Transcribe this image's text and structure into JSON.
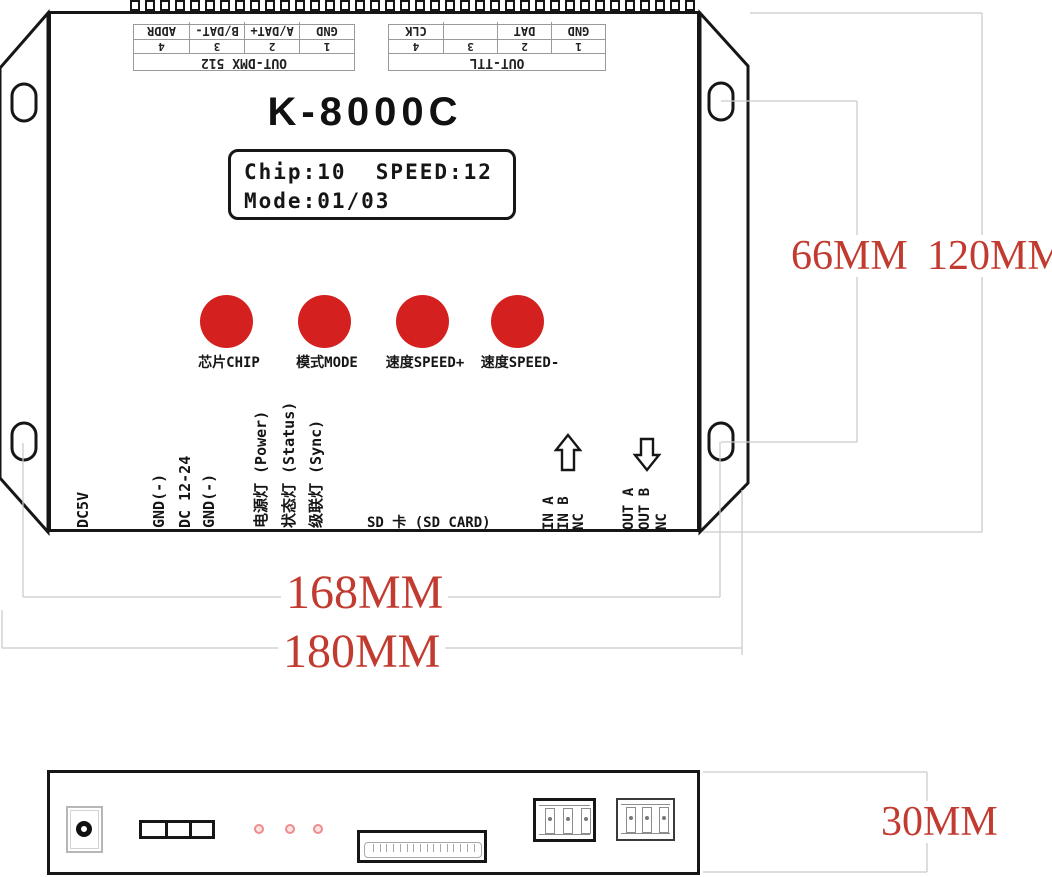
{
  "top_view": {
    "model": "K-8000C",
    "lcd": {
      "line1": "Chip:10  SPEED:12",
      "line2": "Mode:01/03"
    },
    "buttons": [
      {
        "label": "芯片CHIP"
      },
      {
        "label": "模式MODE"
      },
      {
        "label": "速度SPEED+"
      },
      {
        "label": "速度SPEED-"
      }
    ],
    "top_ports": [
      {
        "title": "OUT-DMX 512",
        "pins": [
          {
            "num": "1",
            "name": "GND"
          },
          {
            "num": "2",
            "name": "A/DAT+"
          },
          {
            "num": "3",
            "name": "B/DAT-"
          },
          {
            "num": "4",
            "name": "ADDR"
          }
        ]
      },
      {
        "title": "OUT-TTL",
        "pins": [
          {
            "num": "1",
            "name": "GND"
          },
          {
            "num": "2",
            "name": "DAT"
          },
          {
            "num": "3",
            "name": ""
          },
          {
            "num": "4",
            "name": "CLK"
          }
        ]
      }
    ],
    "power_labels": [
      "DC5V",
      "GND(-)",
      "DC 12-24",
      "GND(-)"
    ],
    "led_labels": [
      "电源灯 (Power)",
      "状态灯 (Status)",
      "级联灯 (Sync)"
    ],
    "sd_label": "SD 卡 (SD CARD)",
    "in_labels": [
      "IN A",
      "IN B",
      "NC"
    ],
    "out_labels": [
      "OUT A",
      "OUT B",
      "NC"
    ]
  },
  "dimensions": {
    "hole_span": "66MM",
    "height": "120MM",
    "mount_width": "168MM",
    "total_width": "180MM",
    "depth": "30MM"
  },
  "colors": {
    "button_red": "#d42120",
    "dimension_red": "#c23b30",
    "led_pink": "#ed8d8d",
    "line_gray": "#c9c9c9",
    "outline_black": "#161616"
  }
}
